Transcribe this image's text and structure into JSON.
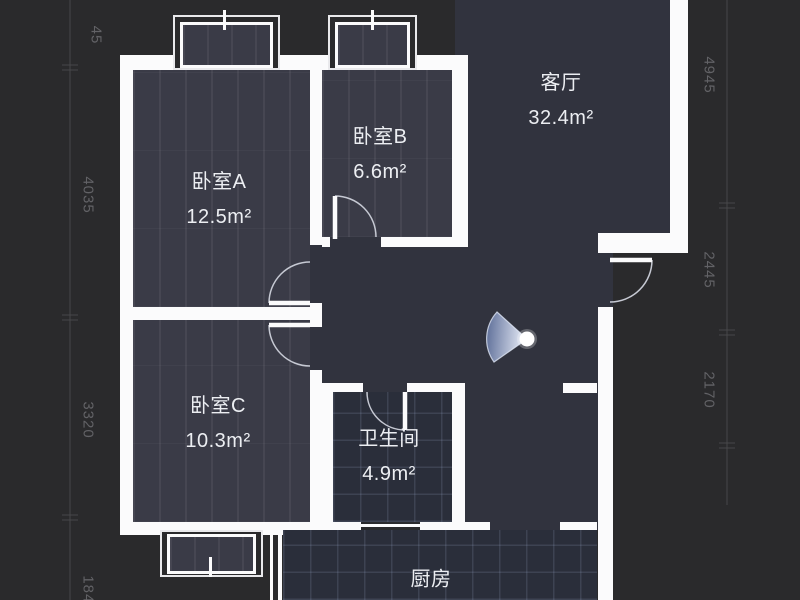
{
  "rooms": {
    "living": {
      "name": "客厅",
      "area": "32.4m²"
    },
    "bedroomA": {
      "name": "卧室A",
      "area": "12.5m²"
    },
    "bedroomB": {
      "name": "卧室B",
      "area": "6.6m²"
    },
    "bedroomC": {
      "name": "卧室C",
      "area": "10.3m²"
    },
    "bathroom": {
      "name": "卫生间",
      "area": "4.9m²"
    },
    "kitchen": {
      "name": "厨房"
    }
  },
  "dimensions": {
    "left": [
      "45",
      "4035",
      "3320",
      "1848"
    ],
    "right": [
      "4945",
      "2445",
      "2170"
    ]
  },
  "icons": {
    "camera_view_cone": "camera-view-cone"
  },
  "colors": {
    "background": "#2a2a2c",
    "wall": "#fbfbfc",
    "floor": "#31333e",
    "bedroom_floor": "#3a3b47",
    "tile_floor": "#2a2e3a",
    "cone_blue": "#8fa3cf",
    "label_text": "#eceef2",
    "dimension_text": "#626266"
  }
}
